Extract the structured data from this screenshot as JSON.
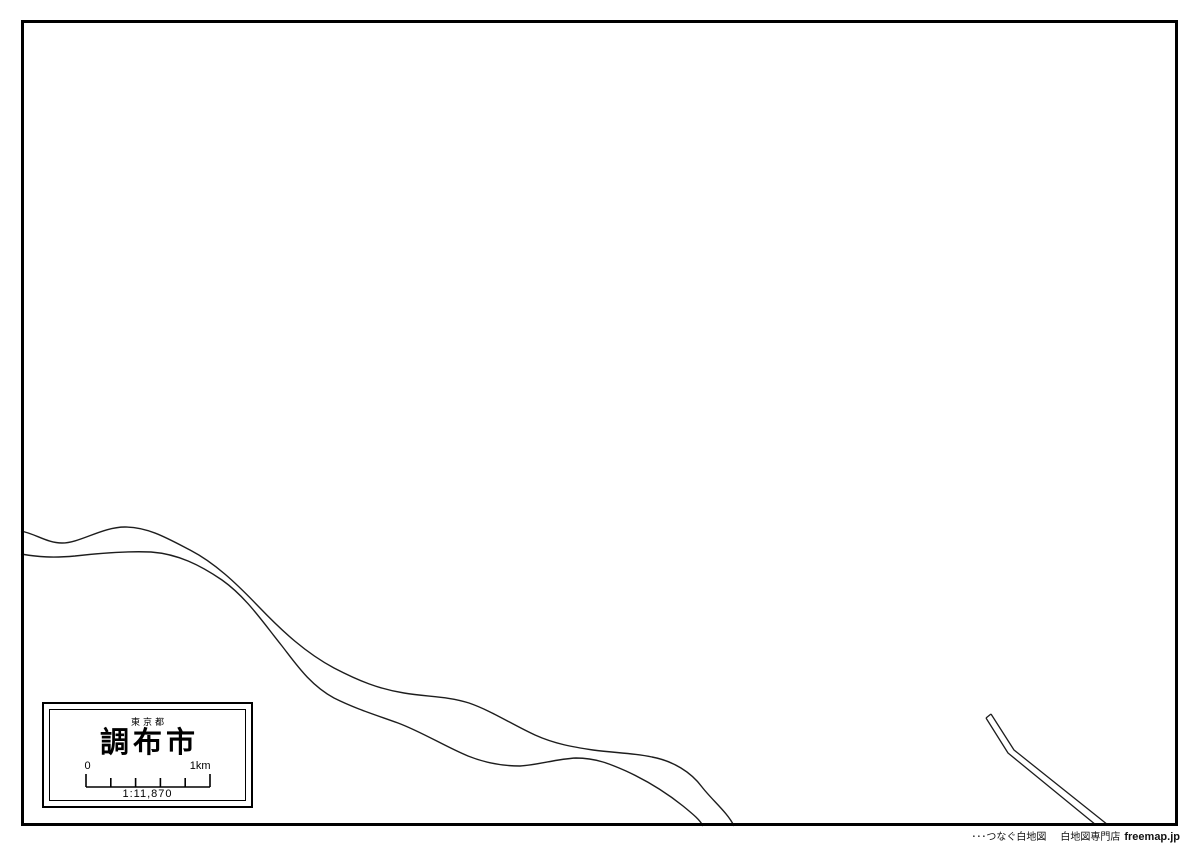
{
  "page": {
    "background_color": "#ffffff",
    "line_color": "#1d1d1d",
    "frame_color": "#000000"
  },
  "legend": {
    "prefecture": "東京都",
    "city": "調布市",
    "scale": {
      "start_label": "0",
      "end_label": "1km",
      "ratio_label": "1:11,870"
    }
  },
  "map": {
    "features": {
      "river_upper_bank": "M 21 531 C 36 534 47 543 62 543 C 80 543 102 527 125 527 C 148 527 167 538 190 550 C 215 563 236 583 259 607 C 283 632 306 653 334 668 C 359 681 379 689 404 693 C 427 697 447 696 469 703 C 492 711 513 725 535 735 C 555 744 573 747 593 750 C 615 753 634 753 652 757 C 673 761 691 772 702 787 C 712 800 728 813 734 826",
      "river_lower_bank": "M 21 554 C 38 557 53 558 75 556 C 101 553 127 551 151 552 C 178 554 200 565 222 580 C 246 597 262 621 282 646 C 296 664 310 685 334 698 C 356 709 376 715 398 723 C 422 732 446 747 468 756 C 488 764 506 766 520 766 C 538 765 556 759 576 758 C 596 758 610 764 626 771 C 650 782 668 794 683 806 C 694 815 700 820 703 826",
      "channel_left_edge": "M 986 718 L 1008 753 L 1096 825",
      "channel_right_edge": "M 991 714 L 1014 750 L 1108 825",
      "channel_end_cap": "M 986 718 L 991 714"
    }
  },
  "footer": {
    "tagline": "･･･つなぐ白地図",
    "store": "白地図専門店",
    "brand": "freemap.jp"
  }
}
